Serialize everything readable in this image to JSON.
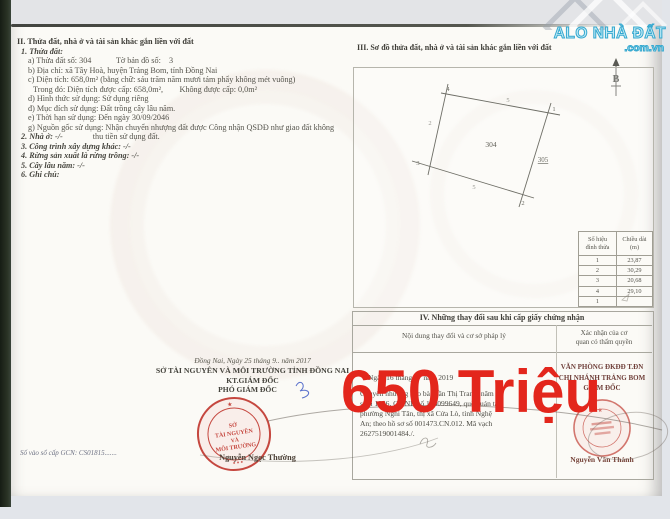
{
  "colors": {
    "price_red": "#e3261c",
    "stamp_red": "#c5473f",
    "logo_blue": "#3aa9d0",
    "ink": "#55544c"
  },
  "price": "650 Triệu",
  "logo": {
    "line1": "ALO NHÀ ĐẤT",
    "line2": ".com.vn"
  },
  "section2": {
    "title": "II. Thửa đất, nhà ở và tài sản khác gắn liền với đất",
    "item1": "1. Thửa đất:",
    "line_a": "a) Thửa đất số: 304            Tờ bản đồ số:    3",
    "line_b": "b) Địa chỉ: xã Tây Hoà, huyện Trảng Bom, tỉnh Đồng Nai",
    "line_c": "c) Diện tích: 658,0m² (bằng chữ: sáu trăm năm mươi tám phẩy không mét vuông)",
    "line_c2": "Trong đó: Diện tích được cấp: 658,0m²,        Không được cấp: 0,0m²",
    "line_d": "d) Hình thức sử dụng: Sử dụng riêng",
    "line_dd": "đ) Mục đích sử dụng: Đất trồng cây lâu năm.",
    "line_e": "e) Thời hạn sử dụng: Đến ngày 30/09/2046",
    "line_g": "g) Nguồn gốc sử dụng: Nhận chuyển nhượng đất được Công nhận QSDĐ như giao đất không",
    "item2": "2. Nhà ở: -/-",
    "line_g2": "thu tiền sử dụng đất.",
    "item3": "3. Công trình xây dựng khác: -/-",
    "item4": "4. Rừng sản xuất là rừng trồng: -/-",
    "item5": "5. Cây lâu năm: -/-",
    "item6": "6. Ghi chú:"
  },
  "section3": {
    "title": "III. Sơ đồ thửa đất, nhà ở và tài sản khác gắn liền với đất",
    "north": "B",
    "plot": {
      "parcel": "304",
      "neighbor": "305",
      "v1": "1",
      "v2": "2",
      "v3": "3",
      "v4": "4",
      "e_top": "5",
      "e_left": "2",
      "e_bottom": "5"
    },
    "table": {
      "h1a": "Số hiệu",
      "h1b": "đỉnh thửa",
      "h2a": "Chiều dài",
      "h2b": "(m)",
      "rows": [
        [
          "1",
          "23,87"
        ],
        [
          "2",
          "30,29"
        ],
        [
          "3",
          "20,68"
        ],
        [
          "4",
          "29,10"
        ],
        [
          "1",
          ""
        ]
      ]
    }
  },
  "section4": {
    "title": "IV. Những thay đổi sau khi cấp giấy chứng nhận",
    "col_left": "Nội dung thay đổi và cơ sở pháp lý",
    "col_right_1": "Xác nhận của cơ",
    "col_right_2": "quan có thẩm quyền",
    "date": "Ngày 16 tháng 07 năm 2019",
    "lines": [
      "Chuyển nhượng cho bà Trần Thị Trang, năm",
      "sinh 1986, CMND số 186099649, quê quán tại",
      "phường Nghi Tân, thị xã Cửa Lò, tỉnh Nghệ",
      "An; theo hồ sơ số 001473.CN.012. Mã vạch",
      "2627519001484./."
    ],
    "office1": "VĂN PHÒNG ĐKĐĐ T.ĐN",
    "office2": "CHI NHÁNH TRẢNG BOM",
    "office3": "GIÁM ĐỐC",
    "signer": "Nguyễn Văn Thành"
  },
  "footer_left": {
    "date": "Đồng Nai, Ngày 25 tháng 9.. năm 2017",
    "org": "SỞ TÀI NGUYÊN VÀ MÔI TRƯỜNG TỈNH ĐỒNG NAI",
    "kt": "KT.GIÁM ĐỐC",
    "deputy": "PHÓ GIÁM ĐỐC",
    "signer": "Nguyễn Ngọc Thường",
    "book_no": "Số vào sổ cấp GCN: CS01815.......",
    "stamp": [
      "SỞ",
      "TÀI NGUYÊN",
      "VÀ",
      "MÔI TRƯỜNG"
    ]
  }
}
